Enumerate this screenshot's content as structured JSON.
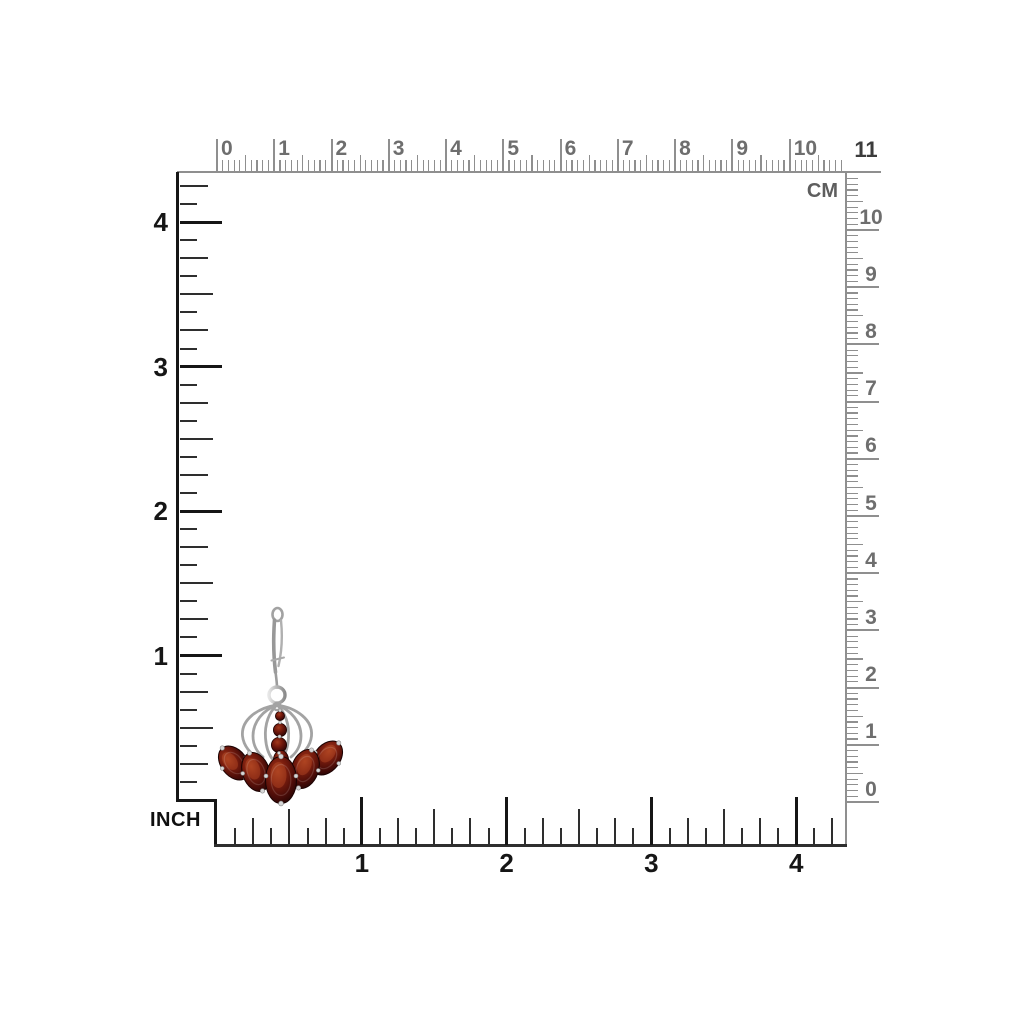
{
  "page": {
    "background": "#ffffff"
  },
  "measurement_grid": {
    "unit_labels": {
      "cm": "CM",
      "inch": "INCH",
      "cm_end": "11"
    },
    "top_cm_ruler": {
      "labels": [
        "0",
        "1",
        "2",
        "3",
        "4",
        "5",
        "6",
        "7",
        "8",
        "9",
        "10"
      ]
    },
    "right_cm_ruler": {
      "labels": [
        "0",
        "1",
        "2",
        "3",
        "4",
        "5",
        "6",
        "7",
        "8",
        "9",
        "10"
      ]
    },
    "left_inch_ruler": {
      "labels": [
        "1",
        "2",
        "3",
        "4"
      ]
    },
    "bottom_inch_ruler": {
      "labels": [
        "1",
        "2",
        "3",
        "4"
      ]
    },
    "colors": {
      "cm_ruler": "#8f8f8f",
      "cm_text": "#6e6e6e",
      "inch_ruler_major": "#161616",
      "inch_ruler_minor": "#2e2e2e",
      "inch_text": "#161616"
    }
  },
  "product": {
    "name": "garnet-chandelier-leverback-earring",
    "gem_color": "#5a100c",
    "gem_highlight": "#a13a1c",
    "metal_color": "#a6a6a6",
    "large_gem_count": 5,
    "small_gem_count": 4
  }
}
